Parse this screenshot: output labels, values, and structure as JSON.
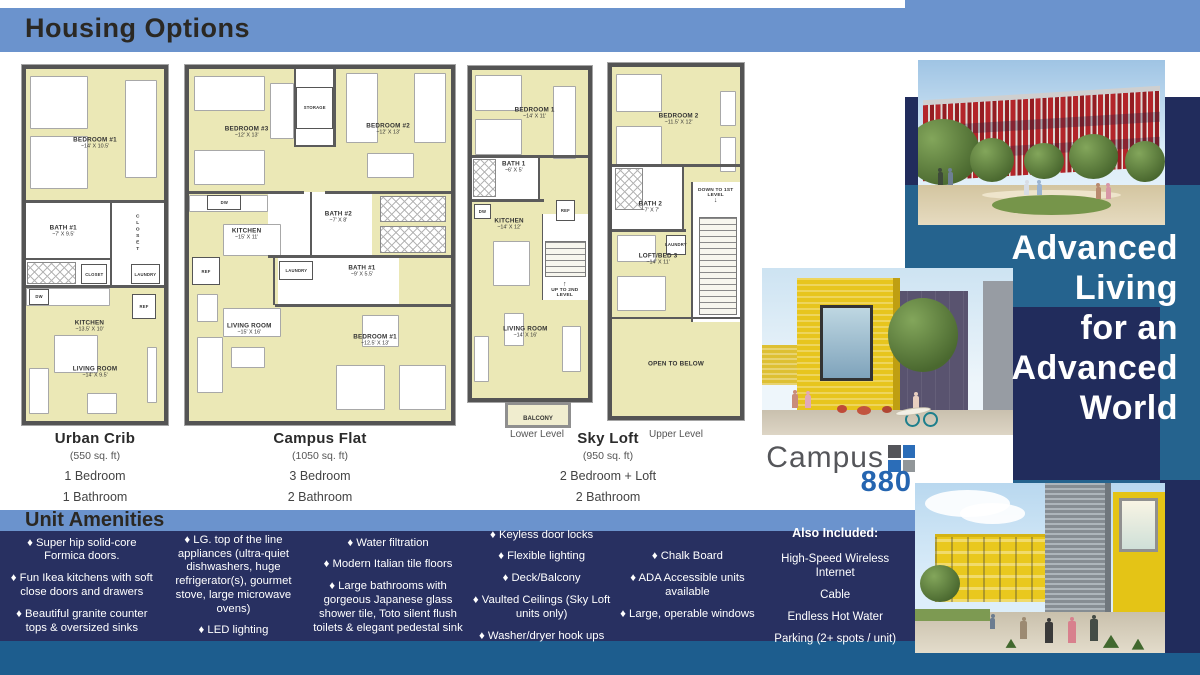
{
  "header": {
    "title": "Housing Options"
  },
  "tagline": {
    "lines": [
      "Advanced",
      "Living",
      "for an",
      "Advanced",
      "World"
    ]
  },
  "logo": {
    "word": "Campus",
    "number": "880"
  },
  "captions": [
    {
      "name": "Urban Crib",
      "sqft": "(550 sq. ft)",
      "specs": [
        "1 Bedroom",
        "1 Bathroom"
      ],
      "cx": 95
    },
    {
      "name": "Campus Flat",
      "sqft": "(1050 sq. ft)",
      "specs": [
        "3 Bedroom",
        "2 Bathroom"
      ],
      "cx": 320
    },
    {
      "name": "Sky Loft",
      "sqft": "(950 sq. ft)",
      "specs": [
        "2 Bedroom + Loft",
        "2 Bathroom"
      ],
      "cx": 608
    }
  ],
  "level_labels": [
    {
      "text": "Lower Level",
      "cx": 537
    },
    {
      "text": "Upper Level",
      "cx": 676
    }
  ],
  "plans": [
    {
      "id": "urban-crib",
      "box": {
        "x": 22,
        "y": 65,
        "w": 146,
        "h": 360
      },
      "white": [
        {
          "x": 0,
          "y": 38,
          "w": 100,
          "h": 24
        }
      ],
      "furn": [
        {
          "x": 3,
          "y": 2,
          "w": 42,
          "h": 15
        },
        {
          "x": 3,
          "y": 19,
          "w": 42,
          "h": 15
        },
        {
          "x": 72,
          "y": 3,
          "w": 23,
          "h": 28
        },
        {
          "x": 0,
          "y": 62.3,
          "w": 61,
          "h": 5
        },
        {
          "x": 20,
          "y": 75.5,
          "w": 32,
          "h": 11
        },
        {
          "x": 2,
          "y": 85,
          "w": 15,
          "h": 13
        },
        {
          "x": 44,
          "y": 92,
          "w": 22,
          "h": 6
        },
        {
          "x": 88,
          "y": 79,
          "w": 7,
          "h": 16
        }
      ],
      "walls": [
        {
          "x": 0,
          "y": 37.3,
          "w": 100,
          "h": 0.8
        },
        {
          "x": 0,
          "y": 61.3,
          "w": 100,
          "h": 0.8
        },
        {
          "x": 61,
          "y": 38,
          "w": 1,
          "h": 24
        },
        {
          "x": 0,
          "y": 53.6,
          "w": 61,
          "h": 0.7
        }
      ],
      "showers": [
        {
          "x": 1,
          "y": 54.8,
          "w": 35,
          "h": 6.3
        }
      ],
      "boxes": [
        {
          "t": "DW",
          "x": 2,
          "y": 62.5,
          "w": 15,
          "h": 4.5
        },
        {
          "t": "REF",
          "x": 77,
          "y": 64,
          "w": 17,
          "h": 7
        },
        {
          "t": "LAUNDRY",
          "x": 76,
          "y": 55.5,
          "w": 21,
          "h": 5.5
        },
        {
          "t": "CLOSET",
          "x": 40,
          "y": 55.5,
          "w": 19,
          "h": 5.5
        }
      ],
      "labels": [
        {
          "t": "BEDROOM #1",
          "d": "~14' X 10.5'",
          "x": 50,
          "y": 21
        },
        {
          "t": "BATH #1",
          "d": "~7' X 9.5'",
          "x": 27,
          "y": 46
        },
        {
          "t": "CLOSET",
          "x": 81,
          "y": 47,
          "vert": 1
        },
        {
          "t": "KITCHEN",
          "d": "~13.5' X 10'",
          "x": 46,
          "y": 73
        },
        {
          "t": "LIVING ROOM",
          "d": "~14' X 9.5'",
          "x": 50,
          "y": 86
        }
      ]
    },
    {
      "id": "campus-flat",
      "box": {
        "x": 185,
        "y": 65,
        "w": 270,
        "h": 360
      },
      "white": [
        {
          "x": 40,
          "y": 0,
          "w": 16,
          "h": 22
        },
        {
          "x": 30,
          "y": 35,
          "w": 40,
          "h": 18
        },
        {
          "x": 34,
          "y": 53,
          "w": 46,
          "h": 14
        }
      ],
      "furn": [
        {
          "x": 2,
          "y": 2,
          "w": 27,
          "h": 10
        },
        {
          "x": 2,
          "y": 23,
          "w": 27,
          "h": 10
        },
        {
          "x": 31,
          "y": 4,
          "w": 9,
          "h": 16
        },
        {
          "x": 60,
          "y": 1,
          "w": 12,
          "h": 20
        },
        {
          "x": 86,
          "y": 1,
          "w": 12,
          "h": 20
        },
        {
          "x": 68,
          "y": 24,
          "w": 18,
          "h": 7
        },
        {
          "x": 0,
          "y": 35.7,
          "w": 30,
          "h": 5
        },
        {
          "x": 13,
          "y": 44,
          "w": 22,
          "h": 9
        },
        {
          "x": 13,
          "y": 68,
          "w": 22,
          "h": 8
        },
        {
          "x": 3,
          "y": 64,
          "w": 8,
          "h": 8
        },
        {
          "x": 16,
          "y": 79,
          "w": 13,
          "h": 6
        },
        {
          "x": 3,
          "y": 76,
          "w": 10,
          "h": 16
        },
        {
          "x": 56,
          "y": 84,
          "w": 19,
          "h": 13
        },
        {
          "x": 80,
          "y": 84,
          "w": 18,
          "h": 13
        },
        {
          "x": 66,
          "y": 70,
          "w": 14,
          "h": 9
        }
      ],
      "walls": [
        {
          "x": 40,
          "y": 0,
          "w": 1,
          "h": 22
        },
        {
          "x": 55,
          "y": 0,
          "w": 1,
          "h": 22
        },
        {
          "x": 40,
          "y": 21.5,
          "w": 16,
          "h": 0.8
        },
        {
          "x": 0,
          "y": 34.8,
          "w": 44,
          "h": 0.8
        },
        {
          "x": 52,
          "y": 34.8,
          "w": 48,
          "h": 0.8
        },
        {
          "x": 30,
          "y": 52.8,
          "w": 70,
          "h": 0.8
        },
        {
          "x": 33,
          "y": 66.8,
          "w": 67,
          "h": 0.8
        },
        {
          "x": 46,
          "y": 35,
          "w": 1,
          "h": 18
        },
        {
          "x": 32,
          "y": 53,
          "w": 1,
          "h": 14
        }
      ],
      "showers": [
        {
          "x": 73,
          "y": 36,
          "w": 25,
          "h": 7.6
        },
        {
          "x": 73,
          "y": 44.6,
          "w": 25,
          "h": 7.6
        }
      ],
      "boxes": [
        {
          "t": "STORAGE",
          "x": 41,
          "y": 5,
          "w": 14,
          "h": 12
        },
        {
          "t": "DW",
          "x": 7,
          "y": 35.7,
          "w": 13,
          "h": 4.5
        },
        {
          "t": "REF",
          "x": 1,
          "y": 53.5,
          "w": 11,
          "h": 8
        },
        {
          "t": "LAUNDRY",
          "x": 34.5,
          "y": 54.5,
          "w": 13,
          "h": 5.5
        }
      ],
      "labels": [
        {
          "t": "BEDROOM #3",
          "d": "~12' X 13'",
          "x": 22,
          "y": 18
        },
        {
          "t": "BEDROOM #2",
          "d": "~12' X 13'",
          "x": 76,
          "y": 17
        },
        {
          "t": "KITCHEN",
          "d": "~15' X 11'",
          "x": 22,
          "y": 47
        },
        {
          "t": "BATH #2",
          "d": "~7' X 8'",
          "x": 57,
          "y": 42
        },
        {
          "t": "BATH #1",
          "d": "~9' X 5.5'",
          "x": 66,
          "y": 57.5
        },
        {
          "t": "LIVING ROOM",
          "d": "~15' X 16'",
          "x": 23,
          "y": 74
        },
        {
          "t": "BEDROOM #1",
          "d": "~12.5' X 13'",
          "x": 71,
          "y": 77
        }
      ]
    },
    {
      "id": "sky-loft-lower",
      "box": {
        "x": 468,
        "y": 66,
        "w": 124,
        "h": 336
      },
      "white": [
        {
          "x": 0,
          "y": 26.5,
          "w": 58,
          "h": 13
        },
        {
          "x": 60,
          "y": 44,
          "w": 40,
          "h": 26
        }
      ],
      "furn": [
        {
          "x": 3,
          "y": 1.5,
          "w": 40,
          "h": 11
        },
        {
          "x": 3,
          "y": 15,
          "w": 40,
          "h": 11
        },
        {
          "x": 70,
          "y": 5,
          "w": 20,
          "h": 22
        },
        {
          "x": 18,
          "y": 52,
          "w": 32,
          "h": 14
        },
        {
          "x": 2,
          "y": 81,
          "w": 13,
          "h": 14
        },
        {
          "x": 28,
          "y": 74,
          "w": 17,
          "h": 10
        },
        {
          "x": 78,
          "y": 78,
          "w": 16,
          "h": 14
        }
      ],
      "walls": [
        {
          "x": 0,
          "y": 25.8,
          "w": 100,
          "h": 0.9
        },
        {
          "x": 0,
          "y": 39.3,
          "w": 62,
          "h": 0.9
        },
        {
          "x": 57,
          "y": 26.5,
          "w": 1.2,
          "h": 13
        },
        {
          "x": 60,
          "y": 44,
          "w": 1,
          "h": 26
        }
      ],
      "showers": [
        {
          "x": 1,
          "y": 27.2,
          "w": 20,
          "h": 11.5
        }
      ],
      "stairs": [
        {
          "x": 63,
          "y": 52,
          "w": 35,
          "h": 11
        }
      ],
      "boxes": [
        {
          "t": "REF",
          "x": 72,
          "y": 39.5,
          "w": 17,
          "h": 6.5
        },
        {
          "t": "DW",
          "x": 2,
          "y": 41,
          "w": 14,
          "h": 4.5
        }
      ],
      "labels": [
        {
          "t": "BEDROOM 1",
          "d": "~14' X 11'",
          "x": 54,
          "y": 13
        },
        {
          "t": "BATH 1",
          "d": "~6' X 5'",
          "x": 36,
          "y": 29.5
        },
        {
          "t": "KITCHEN",
          "d": "~14' X 12'",
          "x": 32,
          "y": 47
        },
        {
          "t": "UP TO 2ND LEVEL",
          "x": 80,
          "y": 67,
          "small": 1,
          "arrow": "↑"
        },
        {
          "t": "LIVING ROOM",
          "d": "~14' X 16'",
          "x": 46,
          "y": 80
        }
      ],
      "balcony": {
        "t": "BALCONY",
        "x": 505,
        "y": 402,
        "w": 66,
        "h": 26
      }
    },
    {
      "id": "sky-loft-upper",
      "box": {
        "x": 608,
        "y": 63,
        "w": 136,
        "h": 357
      },
      "white": [
        {
          "x": 0,
          "y": 28.5,
          "w": 55,
          "h": 18
        },
        {
          "x": 62,
          "y": 33,
          "w": 38,
          "h": 40
        }
      ],
      "furn": [
        {
          "x": 3,
          "y": 2,
          "w": 36,
          "h": 11
        },
        {
          "x": 3,
          "y": 17,
          "w": 36,
          "h": 11
        },
        {
          "x": 84,
          "y": 7,
          "w": 13,
          "h": 10
        },
        {
          "x": 84,
          "y": 20,
          "w": 13,
          "h": 10
        },
        {
          "x": 4,
          "y": 48,
          "w": 30,
          "h": 8
        },
        {
          "x": 4,
          "y": 60,
          "w": 38,
          "h": 10
        },
        {
          "x": 78,
          "y": 59,
          "w": 14,
          "h": 11
        }
      ],
      "walls": [
        {
          "x": 0,
          "y": 27.8,
          "w": 100,
          "h": 0.9
        },
        {
          "x": 0,
          "y": 46.3,
          "w": 58,
          "h": 0.9
        },
        {
          "x": 55,
          "y": 28.5,
          "w": 1.2,
          "h": 18
        },
        {
          "x": 0,
          "y": 71.5,
          "w": 100,
          "h": 0.7
        },
        {
          "x": 62,
          "y": 33,
          "w": 1,
          "h": 40
        }
      ],
      "showers": [
        {
          "x": 2,
          "y": 29,
          "w": 22,
          "h": 12
        }
      ],
      "stairs": [
        {
          "x": 68,
          "y": 43,
          "w": 30,
          "h": 28
        }
      ],
      "boxes": [
        {
          "t": "LAUNDRY",
          "x": 42,
          "y": 48,
          "w": 16,
          "h": 6
        }
      ],
      "labels": [
        {
          "t": "BEDROOM 2",
          "d": "~11.5' X 12'",
          "x": 52,
          "y": 15
        },
        {
          "t": "BATH 2",
          "d": "~7' X 7'",
          "x": 30,
          "y": 40
        },
        {
          "t": "DOWN TO 1ST LEVEL",
          "x": 81,
          "y": 37,
          "small": 1,
          "arrow": "↓",
          "after": 1
        },
        {
          "t": "LOFT/BED 3",
          "d": "~14' X 11'",
          "x": 36,
          "y": 55
        },
        {
          "t": "OPEN TO BELOW",
          "x": 50,
          "y": 85
        }
      ]
    }
  ],
  "amenities": {
    "title": "Unit Amenities",
    "bullet": "♦",
    "columns": [
      {
        "width": 152,
        "items": [
          "Super hip solid-core Formica doors.",
          "Fun Ikea kitchens with soft close doors and drawers",
          "Beautiful granite counter tops & oversized sinks"
        ]
      },
      {
        "width": 148,
        "items": [
          "LG. top of the line appliances (ultra-quiet dishwashers, huge refrigerator(s), gourmet stove, large microwave ovens)",
          "LED lighting"
        ]
      },
      {
        "width": 158,
        "items": [
          "Water filtration",
          "Modern Italian tile floors",
          "Large bathrooms with gorgeous Japanese glass shower tile, Toto silent flush toilets & elegant pedestal sink"
        ]
      },
      {
        "width": 146,
        "items": [
          "Keyless door locks",
          "Flexible lighting",
          "Deck/Balcony",
          "Vaulted Ceilings (Sky Loft units only)",
          "Washer/dryer hook ups"
        ]
      },
      {
        "width": 142,
        "items": [
          "Chalk Board",
          "ADA Accessible units available",
          "Large, operable windows"
        ]
      }
    ],
    "also_included": {
      "width": 150,
      "title": "Also Included:",
      "items": [
        "High-Speed Wireless Internet",
        "Cable",
        "Endless Hot Water",
        "Parking (2+ spots / unit)"
      ]
    }
  },
  "colors": {
    "header_band": "#6b93cd",
    "navy": "#212c5c",
    "amenities_navy": "#283061",
    "teal_panel": "#25638e",
    "bottom_strip": "#1d5d8e",
    "plan_fill": "#ebe8b6",
    "logo_gray": "#55565a",
    "logo_blue": "#2565b0"
  }
}
